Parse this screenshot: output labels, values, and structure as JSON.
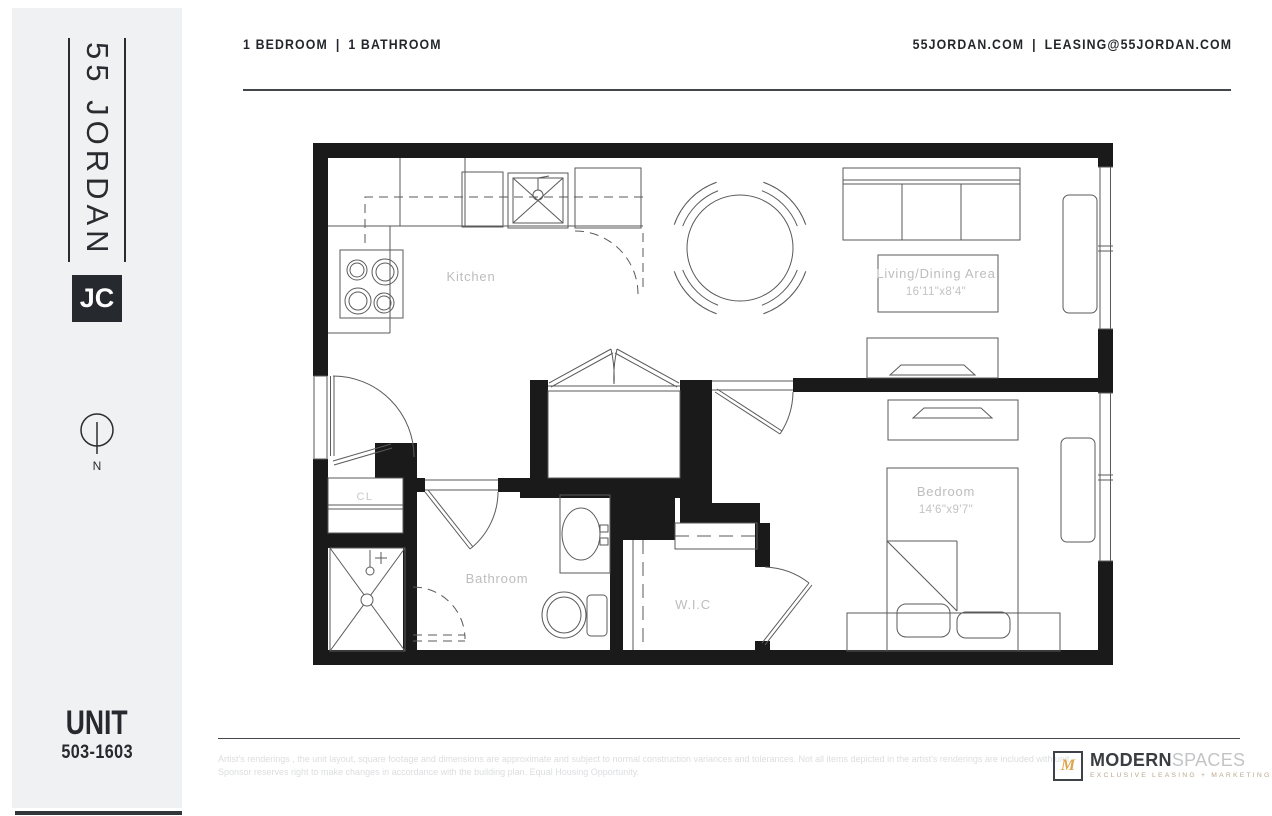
{
  "header": {
    "left": {
      "part1": "1 BEDROOM",
      "separator": "|",
      "part2": "1 BATHROOM"
    },
    "right": {
      "website": "55JORDAN.COM",
      "separator": "|",
      "email": "LEASING@55JORDAN.COM"
    }
  },
  "sidebar": {
    "logo_text": "55 JORDAN",
    "badge": "JC",
    "compass_label": "N",
    "unit_label": "UNIT",
    "unit_number": "503-1603"
  },
  "floorplan": {
    "rooms": {
      "kitchen": {
        "label": "Kitchen"
      },
      "living": {
        "label": "Living/Dining Area",
        "dimensions": "16'11\"x8'4\""
      },
      "closet": {
        "label": "CL"
      },
      "bathroom": {
        "label": "Bathroom"
      },
      "wic": {
        "label": "W.I.C"
      },
      "bedroom": {
        "label": "Bedroom",
        "dimensions": "14'6\"x9'7\""
      }
    }
  },
  "footer": {
    "disclaimer_line1": "Artist's renderings , the unit layout, square footage and dimensions are approximate and subject to normal construction variances and tolerances. Not all items depicted in the artist's renderings are included with unit.",
    "disclaimer_line2": "Sponsor reserves right to make changes in accordance with the building plan. Equal Housing Opportunity.",
    "brand": {
      "mark": "M",
      "name_bold": "MODERN",
      "name_light": "SPACES",
      "tagline": "EXCLUSIVE LEASING + MARKETING"
    }
  },
  "colors": {
    "sidebar_bg": "#f0f1f2",
    "wall": "#1a1a1a",
    "text_dark": "#23262b",
    "label_gray": "#bdbdbd",
    "brand_gold": "#dca54b"
  }
}
